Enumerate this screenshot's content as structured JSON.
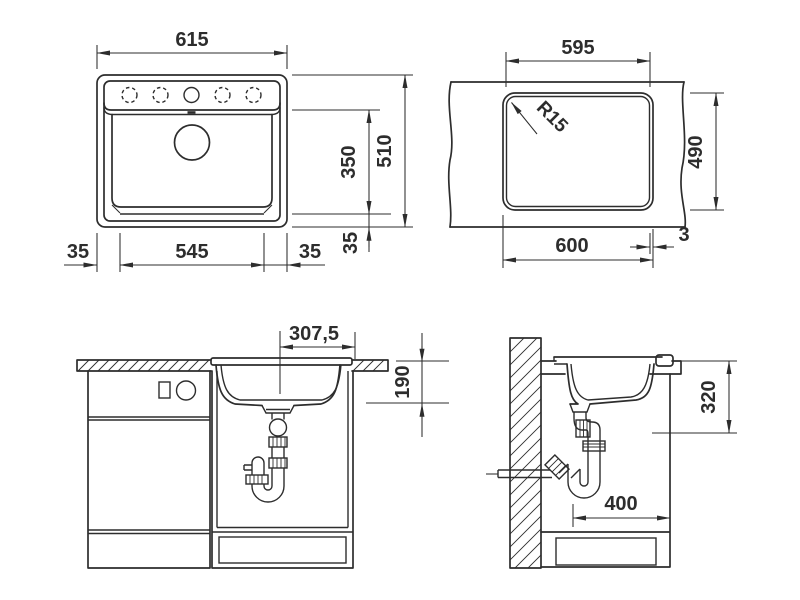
{
  "colors": {
    "ink": "#2d2d2d",
    "paper": "#ffffff"
  },
  "dims": {
    "plan": {
      "overall_width": "615",
      "overall_depth": "510",
      "bowl_depth": "350",
      "bottom_margin": "35",
      "left_margin": "35",
      "bowl_width": "545",
      "right_margin": "35"
    },
    "cutout": {
      "width_top": "595",
      "radius": "R15",
      "depth": "490",
      "width_bottom": "600",
      "offset": "3"
    },
    "front": {
      "drain_offset": "307,5",
      "basin_depth": "190"
    },
    "side": {
      "mount_depth": "320",
      "clearance": "400"
    }
  }
}
